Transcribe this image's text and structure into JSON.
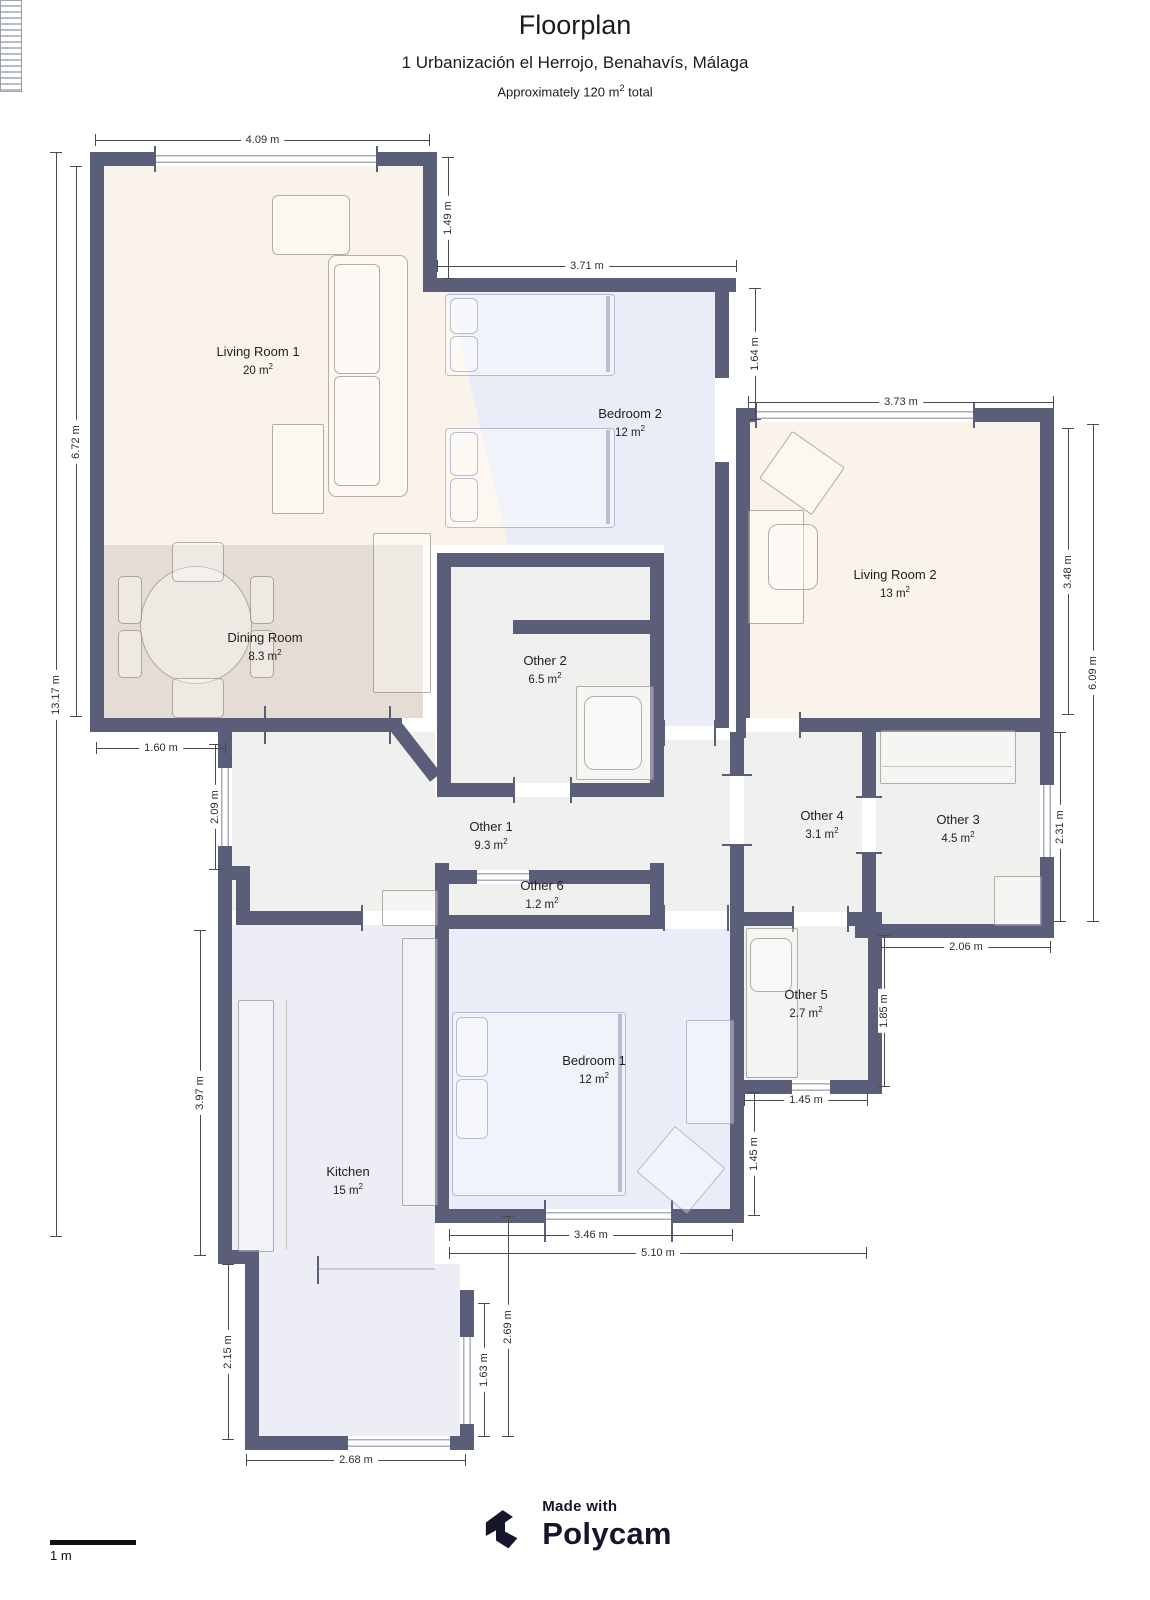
{
  "header": {
    "title": "Floorplan",
    "address": "1 Urbanización el Herrojo, Benahavís, Málaga",
    "area_prefix": "Approximately 120 m",
    "area_sup": "2",
    "area_suffix": " total"
  },
  "units": {
    "sup": "2"
  },
  "rooms": [
    {
      "name": "Living Room 1",
      "area": "20 m"
    },
    {
      "name": "Dining Room",
      "area": "8.3 m"
    },
    {
      "name": "Bedroom 2",
      "area": "12 m"
    },
    {
      "name": "Living Room 2",
      "area": "13 m"
    },
    {
      "name": "Other 2",
      "area": "6.5 m"
    },
    {
      "name": "Other 1",
      "area": "9.3 m"
    },
    {
      "name": "Other 4",
      "area": "3.1 m"
    },
    {
      "name": "Other 3",
      "area": "4.5 m"
    },
    {
      "name": "Other 6",
      "area": "1.2 m"
    },
    {
      "name": "Other 5",
      "area": "2.7 m"
    },
    {
      "name": "Bedroom 1",
      "area": "12 m"
    },
    {
      "name": "Kitchen",
      "area": "15 m"
    }
  ],
  "dims": [
    "4.09 m",
    "1.49 m",
    "6.72 m",
    "13.17 m",
    "3.71 m",
    "1.64 m",
    "3.73 m",
    "3.48 m",
    "6.09 m",
    "2.31 m",
    "2.06 m",
    "1.60 m",
    "2.09 m",
    "3.97 m",
    "1.85 m",
    "1.45 m",
    "1.45 m",
    "3.46 m",
    "5.10 m",
    "2.69 m",
    "1.63 m",
    "2.15 m",
    "2.68 m"
  ],
  "footer": {
    "made_with": "Made with",
    "brand": "Polycam",
    "scale_label": "1 m"
  },
  "palette": {
    "wall": "#5b5e78",
    "living_fill": "#faf3ea",
    "dining_fill": "#e5ddd3",
    "bedroom_fill": "#e9edf8",
    "kitchen_fill": "#ecedf5",
    "other_fill": "#f0f0ee",
    "brand_ink": "#15152b"
  },
  "icons": {
    "brand_mark": "polycam-logo"
  }
}
